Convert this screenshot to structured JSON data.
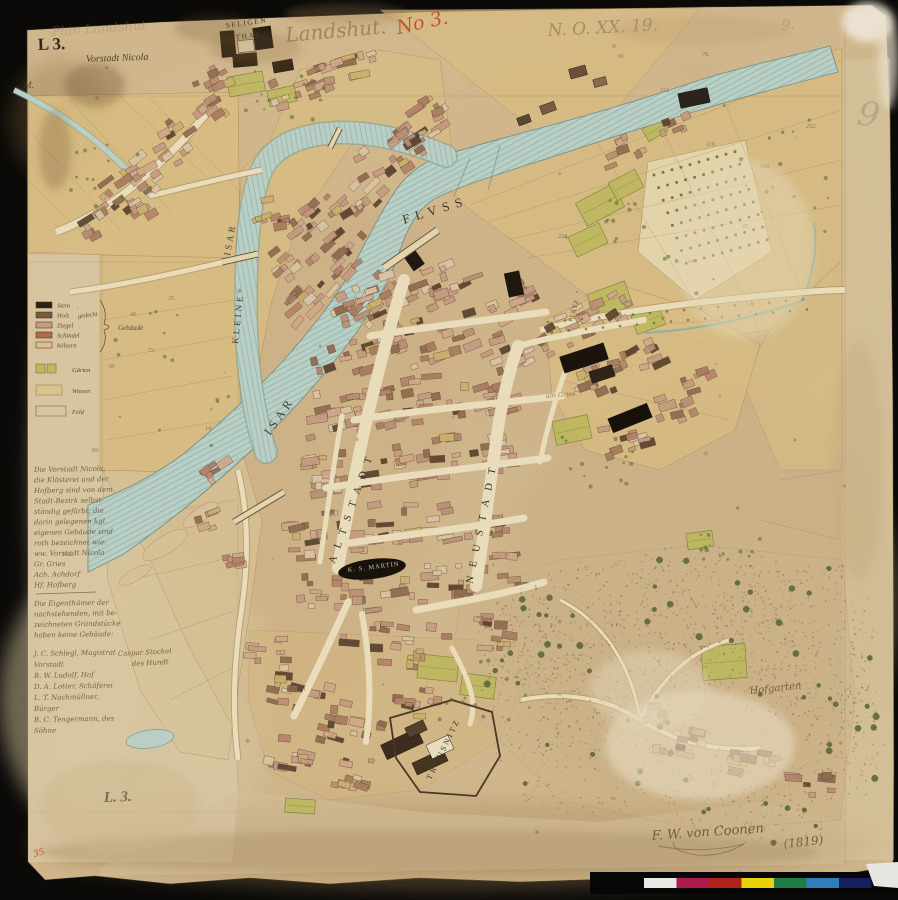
{
  "palette": {
    "backdrop": "#0b0a08",
    "paper": "#cfb68c",
    "margin": "#d8c7a2",
    "field": "#d8bc82",
    "field_pale": "#d6c296",
    "garden": "#bdb75f",
    "garden_edge": "#6d7a34",
    "orchard": "#e4d6b0",
    "water": "#b9cfc5",
    "water_hatch": "#87a89b",
    "water_edge": "#6f8f83",
    "road": "#e9dcba",
    "road_edge": "#a5855a",
    "block_pink": "#c59a80",
    "block_pink2": "#cfa789",
    "block_pink3": "#ba8f74",
    "block_red": "#b5826a",
    "block_brown": "#8f6a4f",
    "block_brown2": "#a87b5e",
    "block_dark": "#5a422e",
    "block_yellow": "#c9b06a",
    "block_light": "#d9c4a4",
    "block_stroke": "#52402e",
    "black_building": "#1d1710",
    "ink": "#3c3226",
    "stipple": "#8a7454",
    "tree": "#55662f",
    "tree_dark": "#3f5026"
  },
  "labels": [
    {
      "id": "stamp-l3",
      "text": "L 3.",
      "x": 38,
      "y": 50,
      "size": 17,
      "rot": -2,
      "cls": "stamp",
      "op": 0.9
    },
    {
      "id": "vorstadt-nicola",
      "text": "Vorstadt Nicola",
      "x": 86,
      "y": 62,
      "size": 10,
      "rot": -2,
      "cls": "ital",
      "op": 0.95
    },
    {
      "id": "seligen",
      "text": "SELIGEN",
      "x": 226,
      "y": 28,
      "size": 7.5,
      "rot": -8,
      "cls": "caps",
      "sp": 1.5,
      "op": 0.95
    },
    {
      "id": "thal",
      "text": "THAL",
      "x": 236,
      "y": 40,
      "size": 7.5,
      "rot": -8,
      "cls": "caps",
      "sp": 1.5,
      "op": 0.95
    },
    {
      "id": "pencil-left",
      "text": "Plan Landshut",
      "x": 52,
      "y": 36,
      "size": 13,
      "rot": -4,
      "cls": "pencil",
      "op": 0.3
    },
    {
      "id": "hand-landshut",
      "text": "Landshut.",
      "x": 286,
      "y": 42,
      "size": 20,
      "rot": -5,
      "cls": "sepia",
      "op": 0.8
    },
    {
      "id": "red-no",
      "text": "No 3.",
      "x": 398,
      "y": 34,
      "size": 19,
      "rot": -12,
      "cls": "red",
      "op": 0.9
    },
    {
      "id": "pencil-no",
      "text": "N. O. XX. 19.",
      "x": 548,
      "y": 36,
      "size": 17,
      "rot": -3,
      "cls": "pencil",
      "op": 0.7
    },
    {
      "id": "pencil-right",
      "text": "9.",
      "x": 782,
      "y": 30,
      "size": 14,
      "rot": -4,
      "cls": "pencil",
      "op": 0.4
    },
    {
      "id": "pencil-nine",
      "text": "9",
      "x": 856,
      "y": 124,
      "size": 34,
      "rot": 10,
      "cls": "pencil",
      "op": 0.35
    },
    {
      "id": "margin-m",
      "text": "M.",
      "x": 24,
      "y": 88,
      "size": 9,
      "rot": 0,
      "cls": "ital",
      "op": 0.8
    },
    {
      "id": "fluss",
      "text": "FLVSS",
      "x": 404,
      "y": 224,
      "size": 13,
      "rot": -17,
      "cls": "caps",
      "sp": 6,
      "op": 0.95
    },
    {
      "id": "isar-kleine-upper",
      "text": "ISAR",
      "x": 230,
      "y": 256,
      "size": 9,
      "rot": -80,
      "cls": "caps",
      "sp": 3,
      "op": 0.9
    },
    {
      "id": "kleine",
      "text": "KLEINE",
      "x": 238,
      "y": 344,
      "size": 9,
      "rot": -84,
      "cls": "caps",
      "sp": 3,
      "op": 0.9
    },
    {
      "id": "isar-main",
      "text": "ISAR",
      "x": 270,
      "y": 436,
      "size": 12,
      "rot": -55,
      "cls": "caps",
      "sp": 4,
      "op": 0.9
    },
    {
      "id": "st-martin",
      "text": "K. S. MARTIN",
      "x": 348,
      "y": 572,
      "size": 6.5,
      "rot": -7,
      "cls": "white",
      "sp": 1,
      "op": 0.95
    },
    {
      "id": "platz",
      "text": "PLATZ",
      "x": 572,
      "y": 322,
      "size": 6,
      "rot": -72,
      "cls": "caps",
      "sp": 1,
      "op": 0.8
    },
    {
      "id": "am-gries",
      "text": "am Gries",
      "x": 546,
      "y": 398,
      "size": 6.5,
      "rot": -4,
      "cls": "script",
      "op": 0.65
    },
    {
      "id": "hofgarten",
      "text": "Hofgarten",
      "x": 750,
      "y": 694,
      "size": 10,
      "rot": -6,
      "cls": "script",
      "op": 0.8
    },
    {
      "id": "caspar-1",
      "text": "Caspar Stockel",
      "x": 118,
      "y": 656,
      "size": 7,
      "rot": -3,
      "cls": "script",
      "op": 0.8
    },
    {
      "id": "caspar-2",
      "text": "des Hundt",
      "x": 132,
      "y": 666,
      "size": 7,
      "rot": -3,
      "cls": "script",
      "op": 0.8
    },
    {
      "id": "bergl",
      "text": "Bergl",
      "x": 288,
      "y": 692,
      "size": 6.5,
      "rot": -5,
      "cls": "script",
      "op": 0.55
    },
    {
      "id": "l3-bottom",
      "text": "L. 3.",
      "x": 104,
      "y": 802,
      "size": 15,
      "rot": -2,
      "cls": "stampital",
      "op": 0.95
    },
    {
      "id": "red-35",
      "text": "35",
      "x": 34,
      "y": 857,
      "size": 9,
      "rot": -15,
      "cls": "red",
      "op": 0.9
    },
    {
      "id": "signature",
      "text": "F. W. von Coonen",
      "x": 652,
      "y": 840,
      "size": 13,
      "rot": -4,
      "cls": "script",
      "op": 0.85
    },
    {
      "id": "sig-year",
      "text": "(1819)",
      "x": 784,
      "y": 848,
      "size": 12,
      "rot": -6,
      "cls": "script",
      "op": 0.8
    }
  ],
  "street_labels": [
    {
      "id": "altstadt",
      "text": "ALTSTADT",
      "path": "M 334 566 L 402 374",
      "size": 10.5,
      "sp": 8.5
    },
    {
      "id": "neustadt",
      "text": "NEUSTADT",
      "path": "M 472 586 L 516 368",
      "size": 10.5,
      "sp": 9
    },
    {
      "id": "trausnitz",
      "text": "TRAUSNITZ",
      "path": "M 430 782 L 464 712",
      "size": 8,
      "sp": 2.5
    }
  ],
  "legend": {
    "building_rows": [
      {
        "color": "#2a2014",
        "label": "Stein"
      },
      {
        "color": "#7b593b",
        "label": "Holz"
      },
      {
        "color": "#c79a82",
        "label": "Ziegel"
      },
      {
        "color": "#b06a4a",
        "label": "Schindel"
      },
      {
        "color": "#d9c092",
        "label": "hölzern"
      }
    ],
    "mid_label": "gedeckt",
    "group_label": "Gebäude",
    "other_rows": [
      {
        "color": "#bdb75f",
        "label": "Gärten",
        "style": "garden"
      },
      {
        "color": "#d9c190",
        "label": "Wiesen",
        "style": "solid"
      },
      {
        "color": "none",
        "label": "Feld",
        "style": "outline"
      }
    ]
  },
  "margin_notes": {
    "para1": [
      "Die Vorstadt Nicola,",
      "die Klösterei und der",
      "Hofberg sind von dem",
      "Stadt-Bezirk selbst-",
      "ständig gefärbt, die",
      "darin gelegenen kgl.",
      "eigenen Gebäude sind",
      "roth bezeichnet wie:",
      "ww. Vorstadt Nicola",
      "Gr.  Gries",
      "Ach. Achdorf",
      "Hf.  Hofberg"
    ],
    "para2": [
      "Die Eigenthümer der",
      "nachstehenden, mit be-",
      "zeichneten Gründstücke",
      "haben keine Gebäude:"
    ],
    "names": [
      "J. C. Schlegl, Magistrat",
      "      Vorstadt",
      "B. W. Ludolf, Hof",
      "D. A. Lotter, Schäferei",
      "L. T. Nachmüllner,",
      "      Bürger",
      "B. C. Tengermann, des",
      "      Söhne"
    ]
  },
  "plot_numbers": [
    {
      "t": "91.",
      "x": 618,
      "y": 58
    },
    {
      "t": "76.",
      "x": 702,
      "y": 56
    },
    {
      "t": "113.",
      "x": 660,
      "y": 92
    },
    {
      "t": "119.",
      "x": 706,
      "y": 146
    },
    {
      "t": "104.",
      "x": 760,
      "y": 168
    },
    {
      "t": "252.",
      "x": 806,
      "y": 128
    },
    {
      "t": "97.",
      "x": 742,
      "y": 228
    },
    {
      "t": "228.",
      "x": 558,
      "y": 238
    },
    {
      "t": "344.",
      "x": 688,
      "y": 263
    },
    {
      "t": "46.",
      "x": 130,
      "y": 316
    },
    {
      "t": "58.",
      "x": 108,
      "y": 368
    },
    {
      "t": "84.",
      "x": 92,
      "y": 452
    },
    {
      "t": "35.",
      "x": 168,
      "y": 300
    },
    {
      "t": "72.",
      "x": 148,
      "y": 352
    },
    {
      "t": "161.",
      "x": 62,
      "y": 556
    },
    {
      "t": "14.",
      "x": 205,
      "y": 430
    }
  ],
  "colorbar": {
    "segments": [
      "#e8e8e4",
      "#ad1a4c",
      "#b2221a",
      "#e8d20a",
      "#1f7c45",
      "#2e7dbd",
      "#171d5e"
    ]
  }
}
